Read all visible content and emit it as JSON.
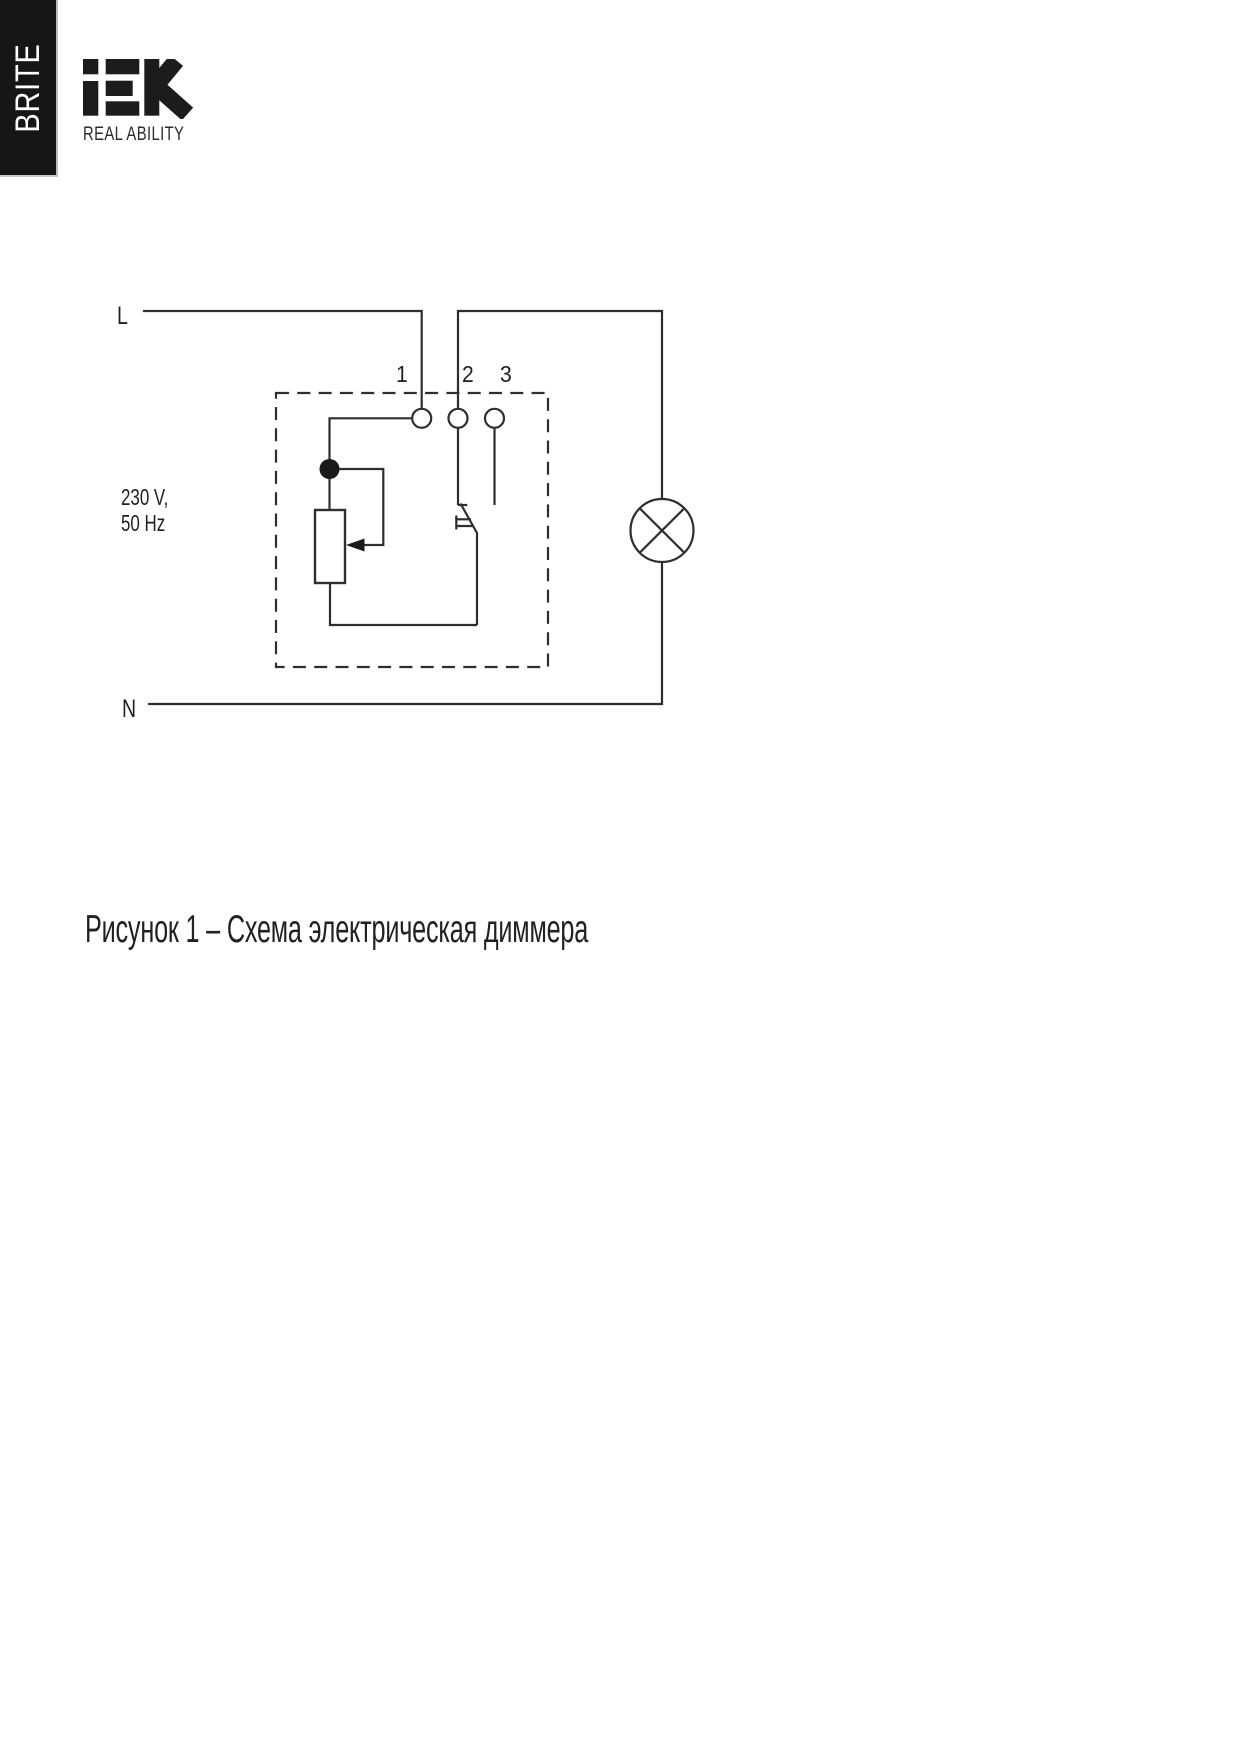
{
  "page": {
    "background_color": "#ffffff",
    "text_color": "#1f1f1f"
  },
  "banner": {
    "text": "BRITE",
    "background_color": "#161616",
    "text_color": "#ffffff"
  },
  "logo": {
    "name": "IEK",
    "tagline": "REAL ABILITY",
    "color": "#1c1c1c"
  },
  "diagram": {
    "stroke_color": "#2e2e2e",
    "labels": {
      "line": "L",
      "neutral": "N",
      "voltage": "230 V,",
      "frequency": "50 Hz",
      "terminal_1": "1",
      "terminal_2": "2",
      "terminal_3": "3"
    },
    "components": {
      "dimmer_box": "dimmer-dashed-enclosure",
      "potentiometer": "potentiometer-with-wiper-arrow",
      "switch": "push-switch",
      "lamp": "lamp-circle-with-cross"
    }
  },
  "caption": {
    "text": "Рисунок 1 – Схема электрическая диммера"
  }
}
